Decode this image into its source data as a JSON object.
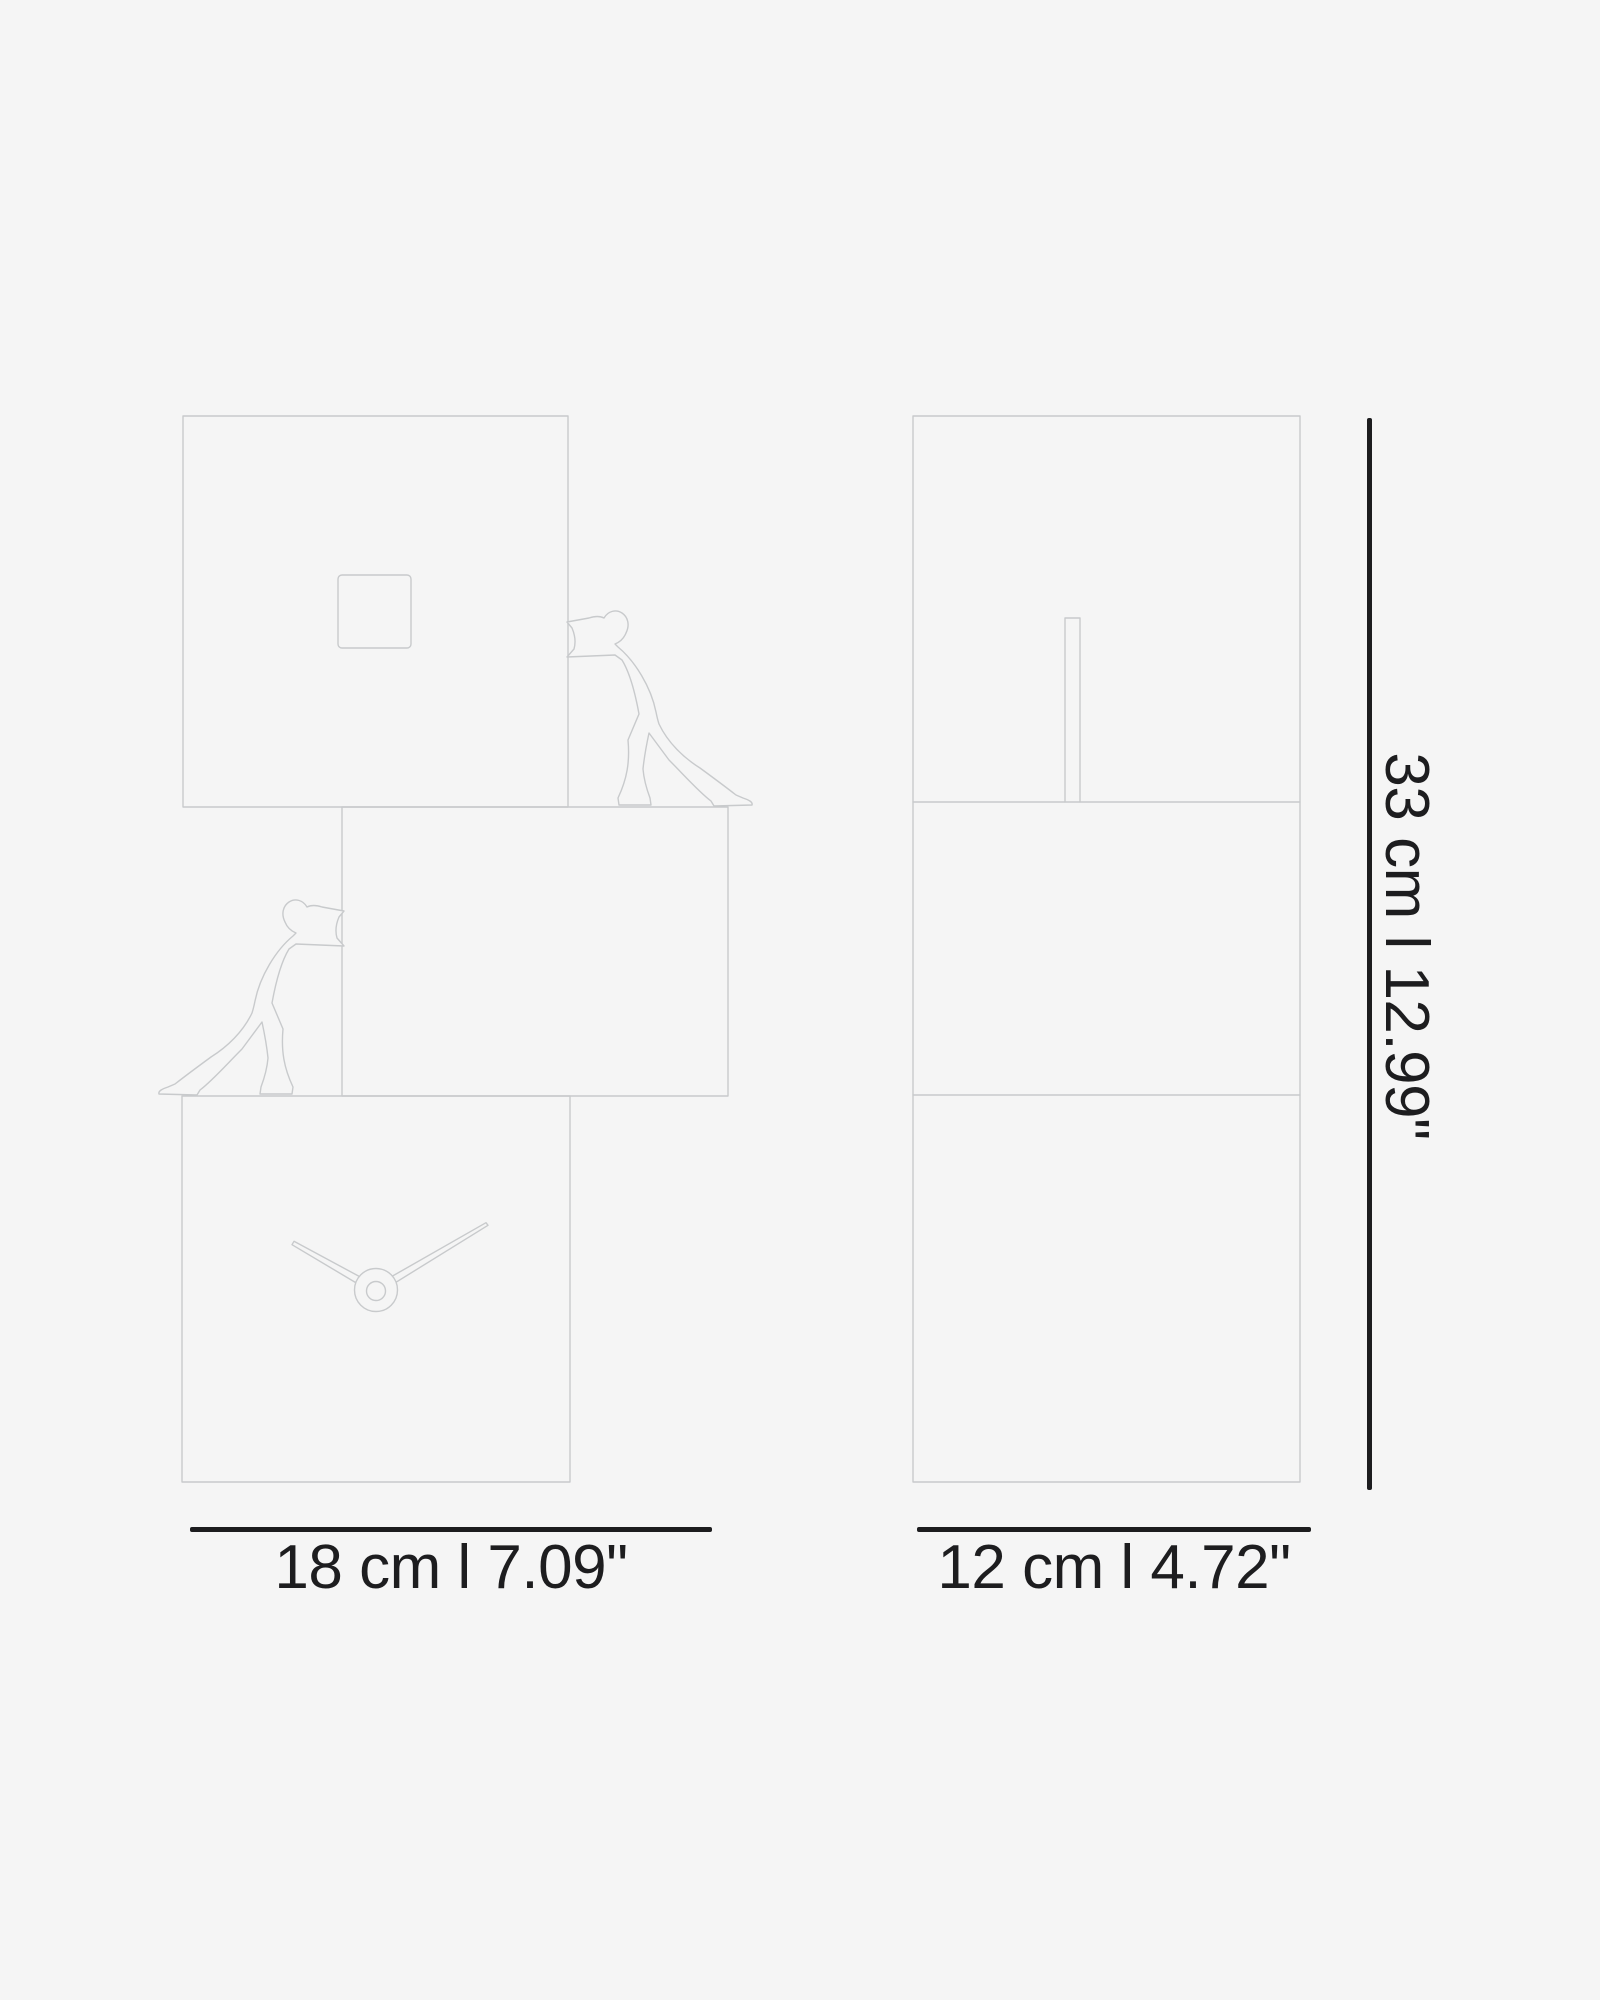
{
  "diagram": {
    "front_width_label": "18 cm l 7.09\"",
    "side_width_label": "12 cm l 4.72\"",
    "height_label": "33 cm l 12.99\""
  },
  "colors": {
    "background": "#f5f5f5",
    "line_art": "#c8cacc",
    "dimension": "#1d1d1f"
  }
}
